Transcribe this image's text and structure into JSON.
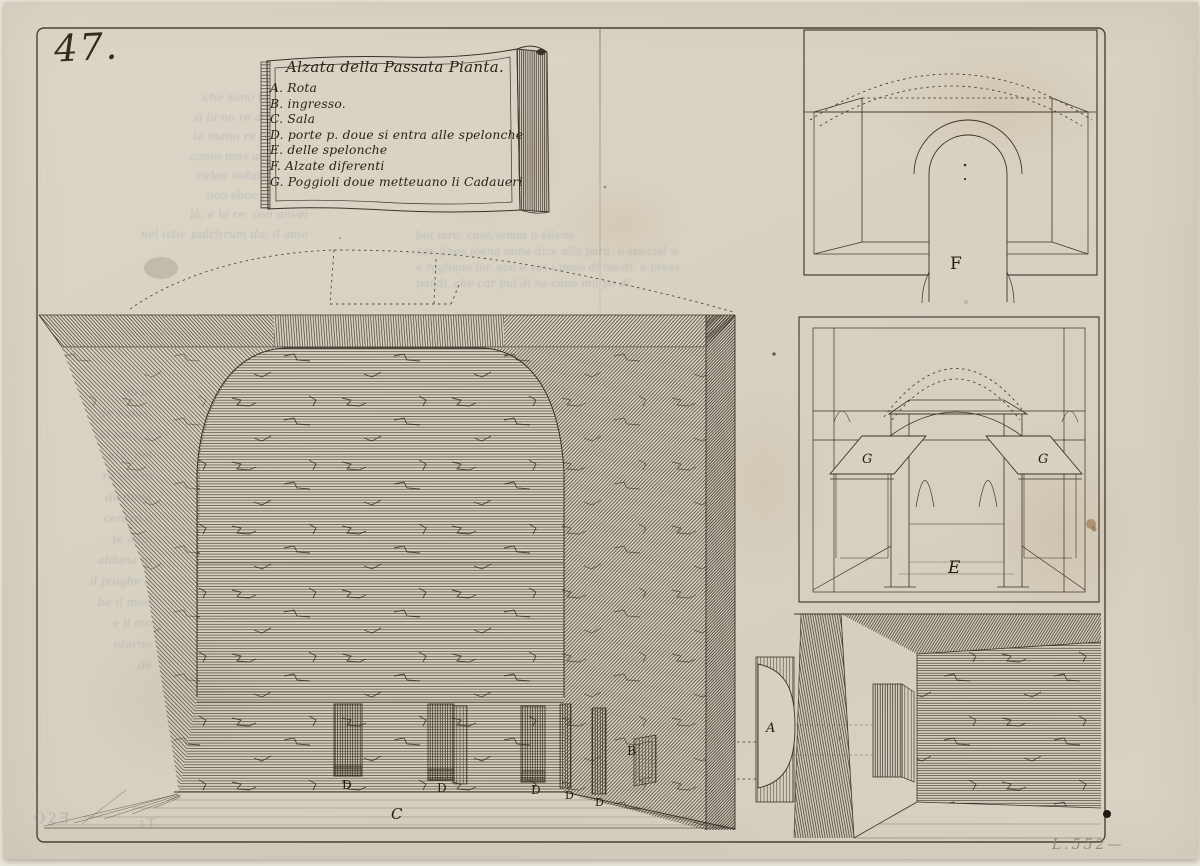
{
  "artwork": {
    "plate_number": "47.",
    "pencil_number": "L.552—"
  },
  "cartouche": {
    "title": "Alzata della Passata Pianta.",
    "legend": [
      "A. Rota",
      "B. ingresso.",
      "C. Sala",
      "D. porte p. doue si entra alle spelonche",
      "E. delle spelonche",
      "F. Alzate diferenti",
      "G. Poggioli doue metteuano li Cadaueri"
    ]
  },
  "figure_labels": {
    "sala": "C",
    "porta": "D",
    "ingresso": "B",
    "alzata": "F",
    "spelonca": "E",
    "poggiolo": "G",
    "rota": "A"
  },
  "showthrough": {
    "top": [
      "bot laro, cuolciemm n elleno",
      "con lineo loena none dice alla para, o special w",
      "e rogliano lor, spo e vas i puso di mesti, o press",
      "pandi, che car pul di ne cano imi po di"
    ],
    "left_upper": [
      "che sono legno ell",
      "si la no re alterata ;",
      "la mano re tescolon",
      "como mas ad la vela",
      "celae notare con le",
      "oco sbuc j incune",
      "là, e la re: con anvei",
      "nel isto: pulchrum da; il amo"
    ],
    "left_lower": [
      "ab in",
      "de Sanis,",
      "al fans, e",
      "eta; pol",
      "re vas m",
      "de dime",
      "centro o",
      "te iean",
      "abbina in",
      "il piughe d",
      "be il mod",
      "e il mo",
      "otorno",
      "de"
    ],
    "plate_marks": [
      "O2Ǝ",
      "ıT"
    ]
  },
  "colors": {
    "paper": "#d7d1c2",
    "ink": "#352d21",
    "ghost_text": "#99a0ab",
    "pencil": "#8b8577"
  }
}
